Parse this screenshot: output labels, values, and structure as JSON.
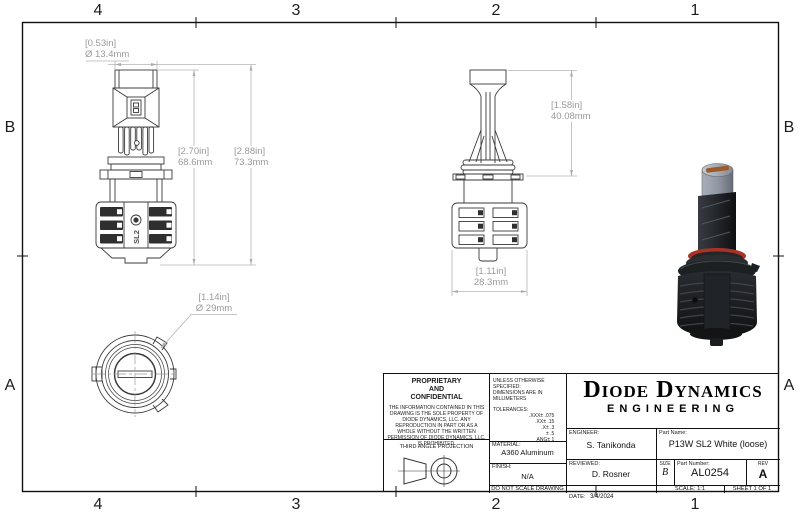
{
  "sheet": {
    "zones_top": [
      "4",
      "3",
      "2",
      "1"
    ],
    "zones_bottom": [
      "4",
      "3",
      "2",
      "1"
    ],
    "zones_left": [
      "B",
      "A"
    ],
    "zones_right": [
      "B",
      "A"
    ]
  },
  "views": {
    "marking": "SL2"
  },
  "dims": {
    "tube_dia": {
      "inch": "[0.53in]",
      "mm": "Ø 13.4mm"
    },
    "body_height": {
      "inch": "[2.70in]",
      "mm": "68.6mm"
    },
    "total_height": {
      "inch": "[2.88in]",
      "mm": "73.3mm"
    },
    "upper_length": {
      "inch": "[1.58in]",
      "mm": "40.08mm"
    },
    "heatsink_width": {
      "inch": "[1.11in]",
      "mm": "28.3mm"
    },
    "flange_dia": {
      "inch": "[1.14in]",
      "mm": "Ø 29mm"
    }
  },
  "title_block": {
    "proprietary_title_1": "PROPRIETARY",
    "proprietary_title_2": "AND",
    "proprietary_title_3": "CONFIDENTIAL",
    "proprietary_body": "THE INFORMATION CONTAINED IN THIS DRAWING IS THE SOLE PROPERTY OF DIODE DYNAMICS, LLC.  ANY REPRODUCTION IN PART OR AS A WHOLE WITHOUT THE WRITTEN PERMISSION OF DIODE DYNAMICS, LLC. IS PROHIBITED.",
    "projection_label": "THIRD ANGLE PROJECTION",
    "spec_line_1": "UNLESS OTHERWISE SPECIFIED:",
    "spec_line_2": "DIMENSIONS ARE IN MILLIMETERS",
    "tolerances_label": "TOLERANCES:",
    "tol": [
      ".XXX± .075",
      ".XX± .15",
      ".X± .3",
      "± .5",
      "ANG± 1"
    ],
    "material_label": "MATERIAL:",
    "material_value": "A360 Aluminum",
    "finish_label": "FINISH:",
    "finish_value": "N/A",
    "do_not_scale": "DO NOT SCALE DRAWING",
    "company_name": "Diode Dynamics",
    "company_sub": "ENGINEERING",
    "engineer_label": "ENGINEER:",
    "engineer_value": "S. Tanikonda",
    "reviewed_label": "REVIEWED:",
    "reviewed_value": "D. Rosner",
    "date_label": "DATE:",
    "date_value": "3/4/2024",
    "part_name_label": "Part Name:",
    "part_name_value": "P13W SL2 White (loose)",
    "size_label": "SIZE",
    "size_value": "B",
    "part_number_label": "Part Number:",
    "part_number_value": "AL0254",
    "rev_label": "REV",
    "rev_value": "A",
    "scale_text": "SCALE: 1:1",
    "sheet_text": "SHEET 1 OF 1"
  },
  "colors": {
    "line": "#3a3a3a",
    "dim_text": "#9a9a9a",
    "oring_red": "#a93226",
    "copper_slot": "#9c5a28",
    "tube_gray": "#8e94a0",
    "heatsink_black": "#1d2023"
  }
}
